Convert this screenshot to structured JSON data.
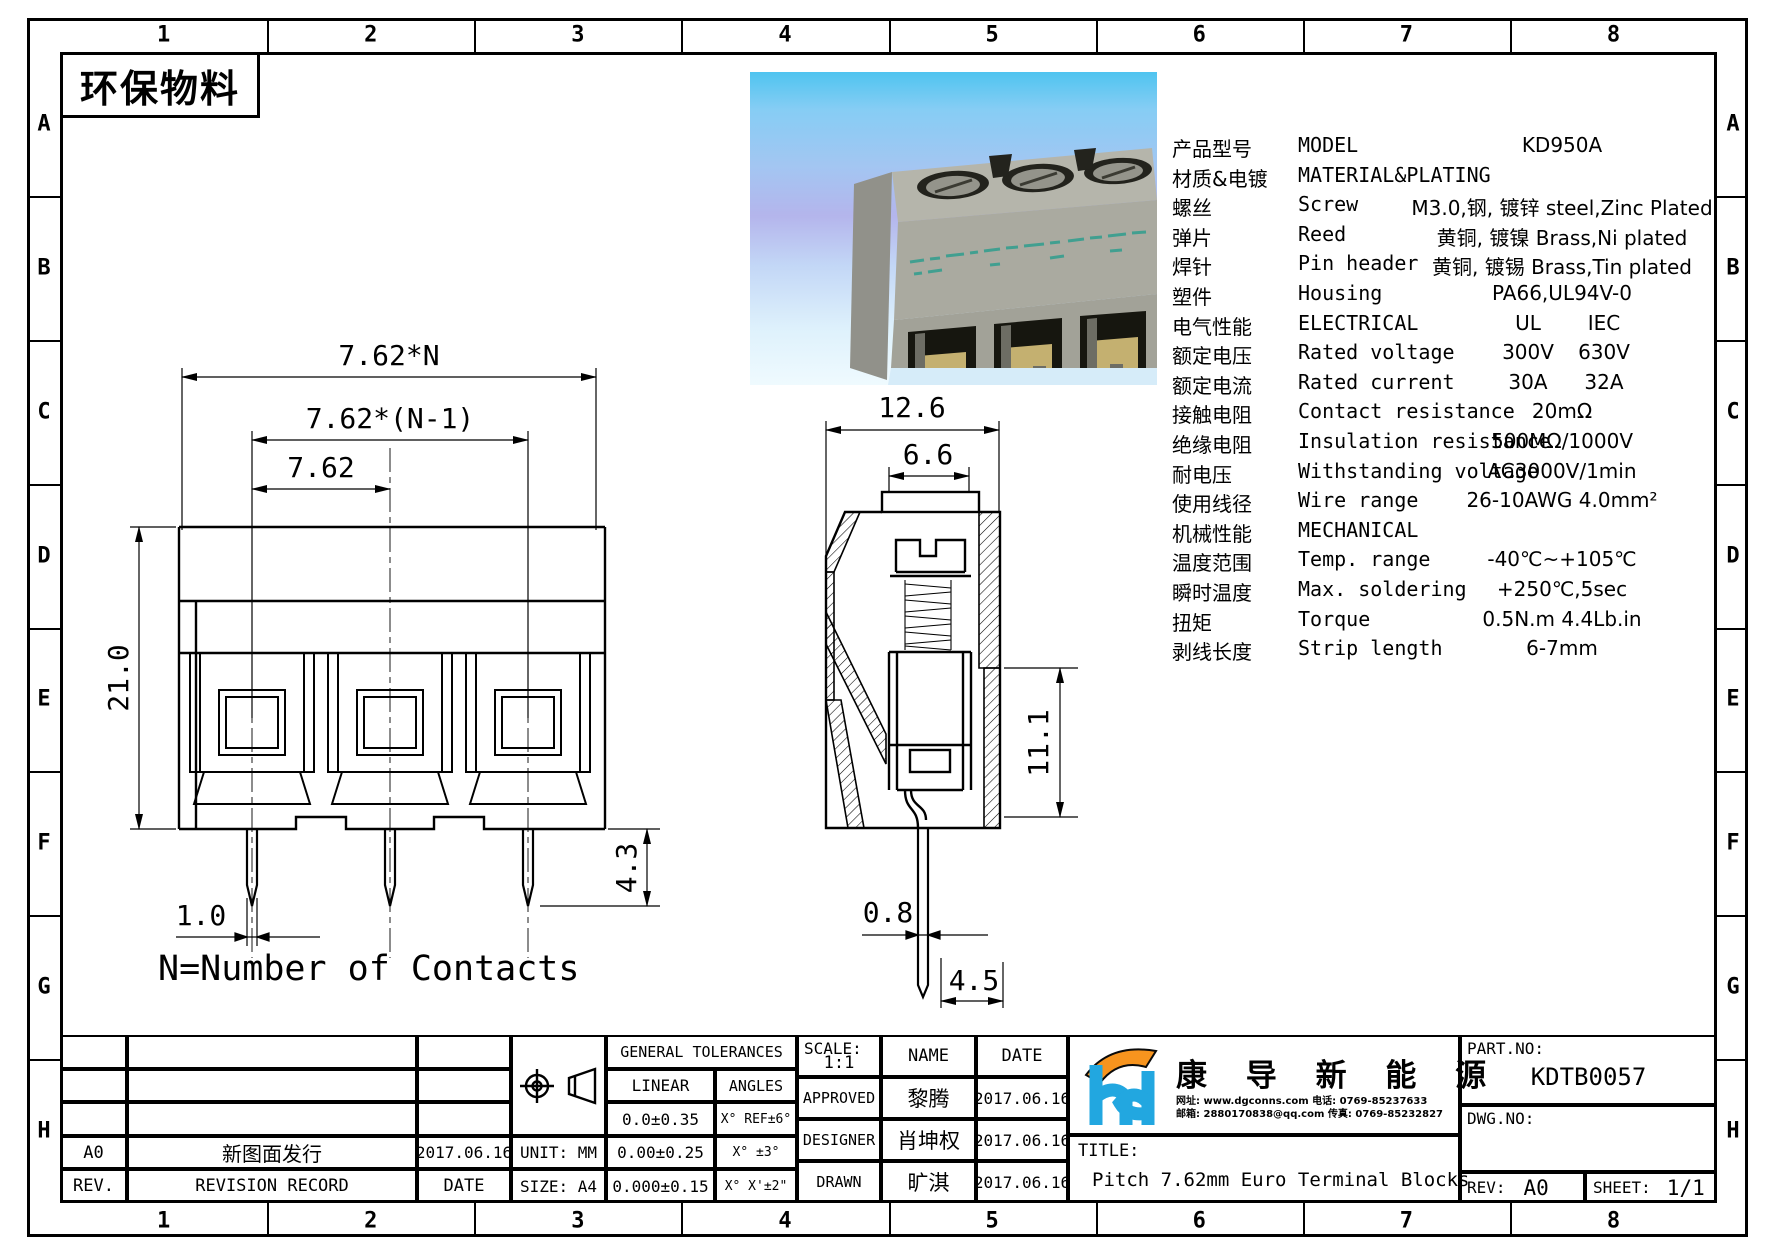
{
  "page": {
    "eco_label": "环保物料"
  },
  "zones": {
    "cols": [
      "1",
      "2",
      "3",
      "4",
      "5",
      "6",
      "7",
      "8"
    ],
    "rows": [
      "A",
      "B",
      "C",
      "D",
      "E",
      "F",
      "G",
      "H"
    ]
  },
  "front_view": {
    "dim_total": "7.62*N",
    "dim_n1": "7.62*(N-1)",
    "dim_pitch": "7.62",
    "dim_height": "21.0",
    "dim_pin_width": "1.0",
    "dim_pin_length": "4.3",
    "note": "N=Number of Contacts"
  },
  "side_view": {
    "dim_width": "12.6",
    "dim_opening": "6.6",
    "dim_body_height": "11.1",
    "dim_pin_thickness": "0.8",
    "dim_pin_offset": "4.5"
  },
  "specs": {
    "rows": [
      {
        "cn": "产品型号",
        "en": "MODEL",
        "v": "KD950A"
      },
      {
        "cn": "材质&电镀",
        "en": "MATERIAL&PLATING",
        "v": ""
      },
      {
        "cn": "螺丝",
        "en": "Screw",
        "v": "M3.0,钢, 镀锌 steel,Zinc Plated"
      },
      {
        "cn": "弹片",
        "en": "Reed",
        "v": "黄铜, 镀镍 Brass,Ni plated"
      },
      {
        "cn": "焊针",
        "en": "Pin header",
        "v": "黄铜, 镀锡 Brass,Tin plated"
      },
      {
        "cn": "塑件",
        "en": "Housing",
        "v": "PA66,UL94V-0"
      },
      {
        "cn": "电气性能",
        "en": "ELECTRICAL",
        "v": "UL",
        "v2": "IEC"
      },
      {
        "cn": "额定电压",
        "en": "Rated voltage",
        "v": "300V",
        "v2": "630V"
      },
      {
        "cn": "额定电流",
        "en": "Rated current",
        "v": "30A",
        "v2": "32A"
      },
      {
        "cn": "接触电阻",
        "en": "Contact resistance",
        "v": "20mΩ"
      },
      {
        "cn": "绝缘电阻",
        "en": "Insulation resistance",
        "v": "500MΩ/1000V"
      },
      {
        "cn": "耐电压",
        "en": "Withstanding voltage",
        "v": "AC3000V/1min"
      },
      {
        "cn": "使用线径",
        "en": "Wire range",
        "v": "26-10AWG 4.0mm²"
      },
      {
        "cn": "机械性能",
        "en": "MECHANICAL",
        "v": ""
      },
      {
        "cn": "温度范围",
        "en": "Temp. range",
        "v": "-40℃~+105℃"
      },
      {
        "cn": "瞬时温度",
        "en": "Max. soldering",
        "v": "+250℃,5sec"
      },
      {
        "cn": "扭矩",
        "en": "Torque",
        "v": "0.5N.m  4.4Lb.in"
      },
      {
        "cn": "剥线长度",
        "en": "Strip length",
        "v": "6-7mm"
      }
    ]
  },
  "title_block": {
    "revision": {
      "rev_value": "A0",
      "record_value": "新图面发行",
      "date_value": "2017.06.16",
      "rev_header": "REV.",
      "record_header": "REVISION RECORD",
      "date_header": "DATE"
    },
    "unit": "UNIT: MM",
    "size": "SIZE: A4",
    "tolerances": {
      "header": "GENERAL TOLERANCES",
      "linear": "LINEAR",
      "angles": "ANGLES",
      "linear_rows": [
        "0.0±0.35",
        "0.00±0.25",
        "0.000±0.15"
      ],
      "angle_rows": [
        "X° REF±6°",
        "X° ±3°",
        "X° X'±2\""
      ]
    },
    "scale_label": "SCALE:",
    "scale_value": "1:1",
    "name_header": "NAME",
    "date_header": "DATE",
    "approvals": [
      {
        "role": "APPROVED",
        "name": "黎腾",
        "date": "2017.06.16"
      },
      {
        "role": "DESIGNER",
        "name": "肖坤权",
        "date": "2017.06.16"
      },
      {
        "role": "DRAWN",
        "name": "旷淇",
        "date": "2017.06.16"
      }
    ],
    "company": {
      "name": "康 导 新 能 源",
      "contact_line1": "网址: www.dgconns.com    电话: 0769-85237633",
      "contact_line2": "邮箱: 2880170838@qq.com 传真: 0769-85232827",
      "logo_blue": "#22a7e0",
      "logo_orange": "#f7941e"
    },
    "title_label": "TITLE:",
    "title_value": "Pitch 7.62mm Euro Terminal Blocks",
    "part_no_label": "PART.NO:",
    "part_no_value": "KDTB0057",
    "dwg_no_label": "DWG.NO:",
    "rev_label": "REV:",
    "rev_value": "A0",
    "sheet_label": "SHEET:",
    "sheet_value": "1/1"
  }
}
